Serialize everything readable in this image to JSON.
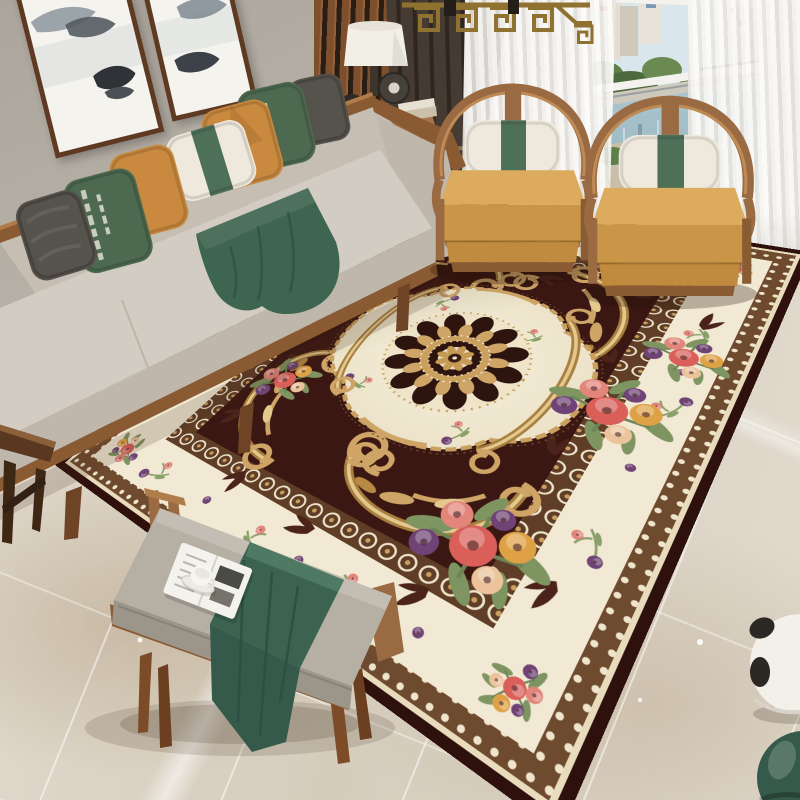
{
  "scene": {
    "type": "photograph",
    "description": "Bright modern Chinese-style living room staged around a large ornate European medallion area rug in dark chocolate, cream and gold with rose bouquets; grey fabric sofa with green and mustard pillows, two curved walnut armchairs by a city-view window, upholstered bench with green runner, magazine and teacup on glossy beige marble tile."
  },
  "objects": [
    {
      "name": "ink-wash-paintings",
      "label": "two framed ink-wash mountain artworks on the wall"
    },
    {
      "name": "fabric-sofa",
      "label": "light grey fabric sofa with walnut wood frame"
    },
    {
      "name": "throw-pillows",
      "label": "grey, green-patterned, mustard and white-green pillows"
    },
    {
      "name": "green-throw-blanket",
      "label": "forest green throw draped over the seat"
    },
    {
      "name": "wood-slat-screen",
      "label": "walnut vertical slat partition screen"
    },
    {
      "name": "table-lamp",
      "label": "white drum-shade lamp on walnut side table with X legs"
    },
    {
      "name": "brass-chandelier",
      "label": "brass geometric fretwork chandelier"
    },
    {
      "name": "window-city-view",
      "label": "window with city towers, trees and river view"
    },
    {
      "name": "sheer-curtains",
      "label": "white sheer curtains"
    },
    {
      "name": "dark-curtain",
      "label": "dark brown drapery panel"
    },
    {
      "name": "armchair-left",
      "label": "curved horseshoe-back walnut armchair with camel cushion"
    },
    {
      "name": "armchair-right",
      "label": "curved horseshoe-back walnut armchair with camel cushion"
    },
    {
      "name": "area-rug",
      "label": "dark brown medallion rug with gold acanthus scrolls, cream bands and flower bouquets"
    },
    {
      "name": "bench",
      "label": "grey upholstered wood bench"
    },
    {
      "name": "green-runner",
      "label": "green cloth runner on the bench"
    },
    {
      "name": "magazine-and-teacup",
      "label": "open magazine with white teacup"
    },
    {
      "name": "marble-floor",
      "label": "glossy beige marble tile floor with reflections"
    },
    {
      "name": "panda-ornament",
      "label": "black and white round floor ornament at right edge"
    },
    {
      "name": "green-floor-ornament",
      "label": "dark green round floor ornament at right edge"
    },
    {
      "name": "accent-table",
      "label": "small dark wood accent table at left edge"
    }
  ],
  "palette": {
    "wall": "#aba59c",
    "wallLight": "#bcb6ac",
    "wood": "#8a5a33",
    "woodDark": "#5f3a22",
    "woodChair": "#9a6a42",
    "woodChairLight": "#c08a55",
    "sofaFabric": "#d3ccc2",
    "sofaShade": "#bfb7ac",
    "pillowGray": "#56524c",
    "pillowGreen": "#4d6a50",
    "pillowOrange": "#c9893f",
    "pillowWhite": "#efe9dd",
    "bandGreen": "#4f7058",
    "throwGreen": "#3e6550",
    "benchCushion": "#b6afa3",
    "benchShade": "#9c9589",
    "runnerGreen": "#3c6350",
    "chairCushion": "#dcab5e",
    "chairCushionDark": "#cb9547",
    "rugField": "#3a1712",
    "rugFieldLeaf": "#4b231a",
    "rugCream": "#f1e9d4",
    "rugGold": "#cfa567",
    "rugGoldDark": "#a97f3f",
    "rugGoldLight": "#e4c98f",
    "rugLace": "#6e4a2e",
    "rugEdge": "#2e100c",
    "flowerCoral": "#d95f58",
    "flowerPink": "#e2857a",
    "flowerPeach": "#ecc39b",
    "flowerOrange": "#dfa146",
    "flowerPurple": "#6f4375",
    "leafGreen": "#7e9562",
    "floorLight": "#e2dbce",
    "floorMid": "#d5ccbc",
    "marbleVein": "#c0ab90",
    "sheer": "#f6f5f2",
    "curtainDark": "#463b32",
    "windowFrame": "#f3f2ee",
    "sky": "#d9e7ec",
    "water": "#9fbac4",
    "treeGreen": "#5d7f49",
    "brass": "#8f7130",
    "decorGreen": "#35594a",
    "pandaWhite": "#f3f0ea",
    "pandaBlack": "#2c2925"
  }
}
